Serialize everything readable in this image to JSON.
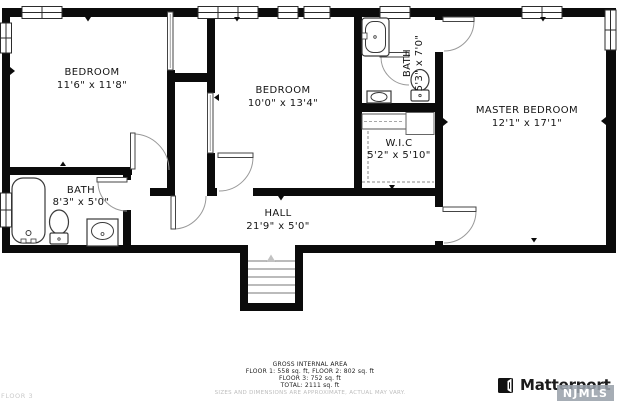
{
  "floorplan": {
    "rooms": [
      {
        "id": "bedroom-1",
        "label": "BEDROOM",
        "dims": "11'6\" x 11'8\""
      },
      {
        "id": "bedroom-2",
        "label": "BEDROOM",
        "dims": "10'0\" x 13'4\""
      },
      {
        "id": "bath-upper",
        "label": "BATH",
        "dims": "5'3\" x 7'0\""
      },
      {
        "id": "master-bedroom",
        "label": "MASTER BEDROOM",
        "dims": "12'1\" x 17'1\""
      },
      {
        "id": "bath-lower",
        "label": "BATH",
        "dims": "8'3\" x 5'0\""
      },
      {
        "id": "walk-in-closet",
        "label": "W.I.C",
        "dims": "5'2\" x 5'10\""
      },
      {
        "id": "hall",
        "label": "HALL",
        "dims": "21'9\" x 5'0\""
      }
    ]
  },
  "footer": {
    "area_title": "GROSS INTERNAL AREA",
    "area_line1": "FLOOR 1: 558 sq. ft, FLOOR 2: 802 sq. ft",
    "area_line2": "FLOOR 3: 752 sq. ft",
    "area_line3": "TOTAL: 2111 sq. ft",
    "disclaimer": "SIZES AND DIMENSIONS ARE APPROXIMATE, ACTUAL MAY VARY.",
    "floor_label": "FLOOR 3"
  },
  "branding": {
    "logo_text": "Matterport",
    "watermark": "NJMLS"
  },
  "colors": {
    "wall": "#0b0b0b",
    "background": "#ffffff",
    "watermark_bg": "#9aa2ab",
    "muted_text": "#c9c9c9"
  }
}
